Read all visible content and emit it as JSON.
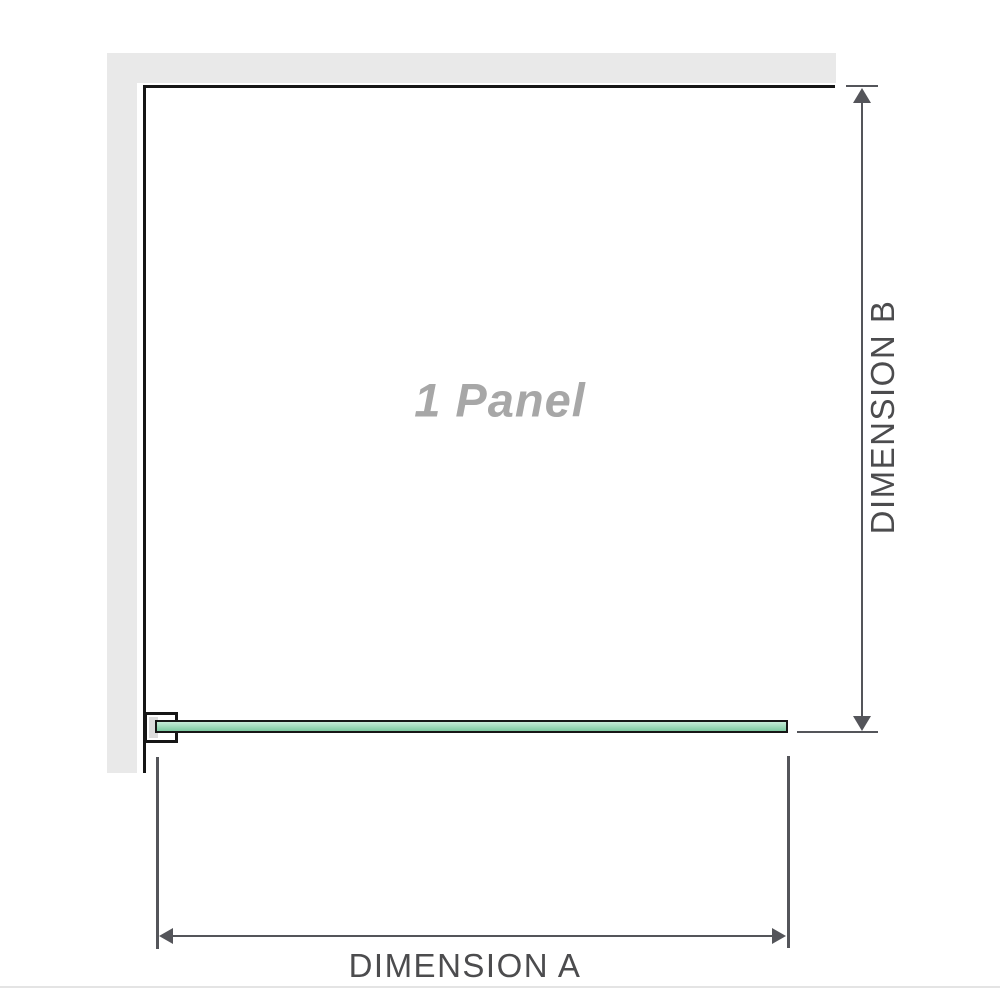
{
  "panel_label": "1 Panel",
  "dimensions": {
    "a_label": "DIMENSION A",
    "b_label": "DIMENSION B"
  },
  "colors": {
    "wall_gray": "#e9e9e9",
    "panel_outline": "#161616",
    "glass_border": "#161616",
    "glass_green_light": "#c6ebd8",
    "glass_green": "#9dd8b8",
    "glass_green_dark": "#7cc9a0",
    "bracket_pad": "#dcdcdc",
    "dimension_line": "#54555a",
    "dimension_text": "#4c4c4e",
    "panel_text": "#a7a7a7",
    "page_divider": "#e4e4e4"
  }
}
